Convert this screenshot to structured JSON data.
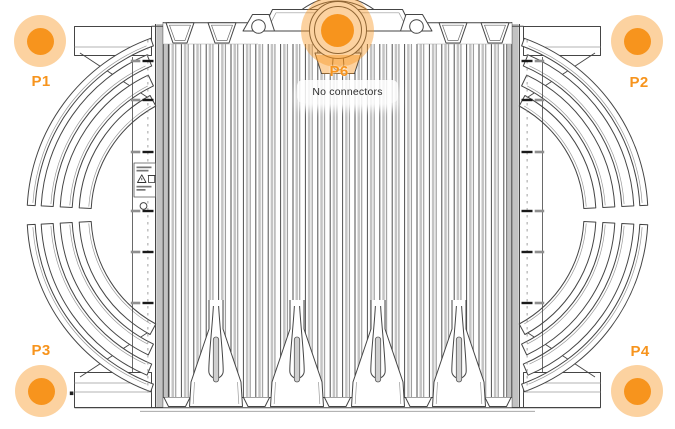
{
  "window": {
    "width": 675,
    "height": 429,
    "background": "#ffffff"
  },
  "drawing": {
    "kind": "device outline technical drawing",
    "colors": {
      "line": "#454545",
      "shading": "#c2c2c2",
      "background": "#ffffff"
    }
  },
  "markers": {
    "p1": {
      "label": "P1"
    },
    "p2": {
      "label": "P2"
    },
    "p3": {
      "label": "P3"
    },
    "p4": {
      "label": "P4"
    },
    "p6": {
      "label": "P6",
      "tooltip": "No connectors"
    }
  },
  "tooltip": {
    "text": "No connectors"
  },
  "colors": {
    "marker_fill": "#F7941D",
    "marker_halo": "rgba(247,148,29,0.42)",
    "marker_label": "#F7941D",
    "tooltip_text": "#2e2e2e"
  },
  "icons": {
    "label_warning": "warning-triangle-icon",
    "label_disposal": "weee-bin-icon"
  }
}
